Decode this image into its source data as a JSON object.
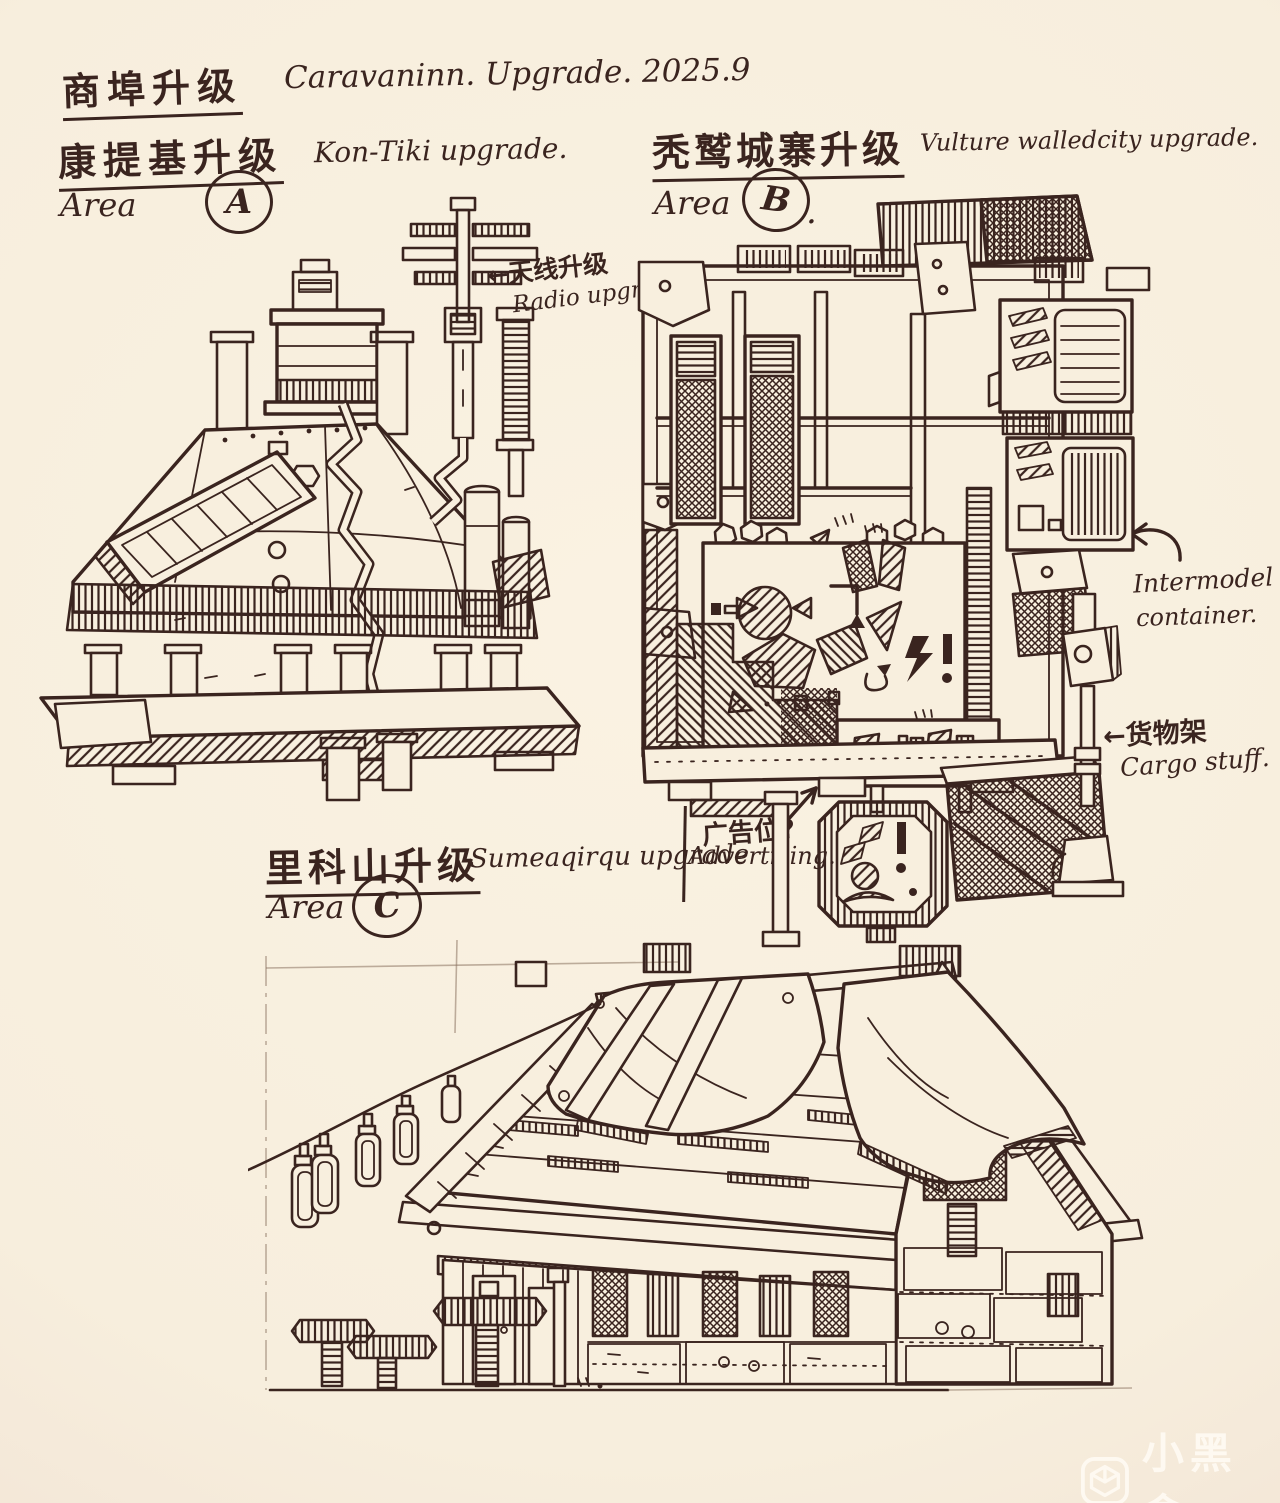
{
  "page": {
    "background_color": "#f7eedd",
    "ink_color": "#3a241f",
    "watermark_color": "#fffcf4"
  },
  "header": {
    "title_zh": "商埠升级",
    "title_en": "Caravaninn. Upgrade. 2025.9"
  },
  "area_a": {
    "title_zh": "康提基升级",
    "title_en": "Kon-Tiki upgrade.",
    "area_word": "Area",
    "area_letter": "A",
    "area_suffix": "",
    "radio_note_zh": "←天线升级",
    "radio_note_en": "Radio upgrade"
  },
  "area_b": {
    "title_zh": "秃鹫城寨升级",
    "title_en": "Vulture walledcity upgrade.",
    "area_word": "Area",
    "area_letter": "B",
    "area_suffix": ".",
    "container_note_line1": "Intermodel",
    "container_note_line2": "container.",
    "cargo_note_zh": "←货物架",
    "cargo_note_en": "Cargo stuff."
  },
  "area_c": {
    "title_zh": "里科山升级",
    "title_en": "Sumeaqirqu upgrade",
    "advertising_note_zh": "广告位?",
    "advertising_note_en": "Advertising.",
    "area_word": "Area",
    "area_letter": "C",
    "area_suffix": ""
  },
  "watermark": {
    "text": "小黑盒"
  }
}
